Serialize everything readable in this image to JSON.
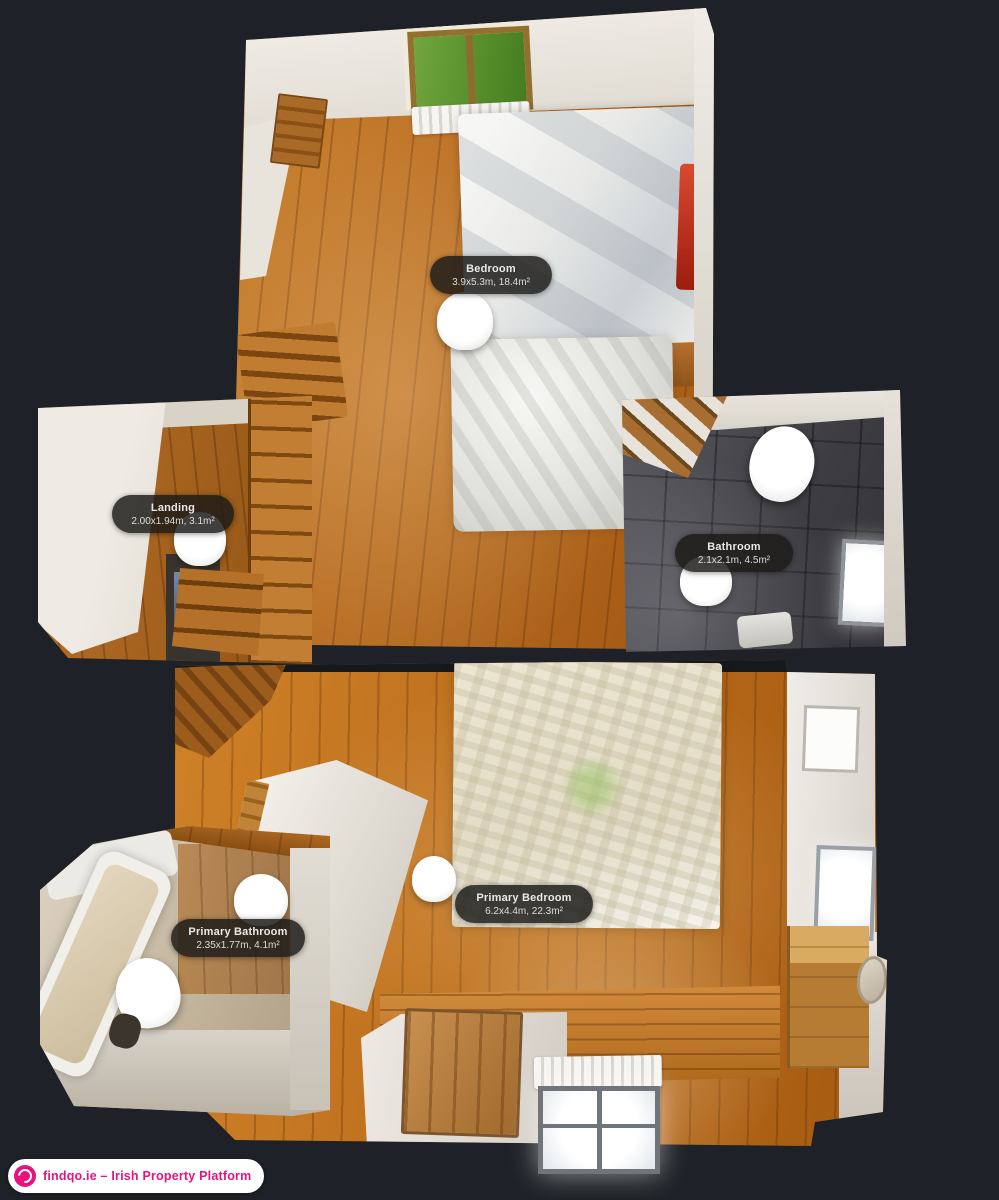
{
  "view": {
    "name": "3D Floor Plan — Dollhouse Top View",
    "background": "#1e2127"
  },
  "rooms": [
    {
      "label": "Bedroom",
      "size": "3.9x5.3m, 18.4m²"
    },
    {
      "label": "Landing",
      "size": "2.00x1.94m, 3.1m²"
    },
    {
      "label": "Bathroom",
      "size": "2.1x2.1m, 4.5m²"
    },
    {
      "label": "Primary Bedroom",
      "size": "6.2x4.4m, 22.3m²"
    },
    {
      "label": "Primary Bathroom",
      "size": "2.35x1.77m, 4.1m²"
    }
  ],
  "watermark": {
    "text": "findqo.ie – Irish Property Platform",
    "icon": "findqo-logo-icon",
    "accent_color": "#e6137e"
  },
  "colors": {
    "background": "#1e2127",
    "label_pill": "rgba(28,26,24,0.84)",
    "marker": "#ffffff",
    "wood_floor": "#b96d22",
    "bathroom_tile": "#3c3c41",
    "accent_pink": "#e6137e"
  }
}
